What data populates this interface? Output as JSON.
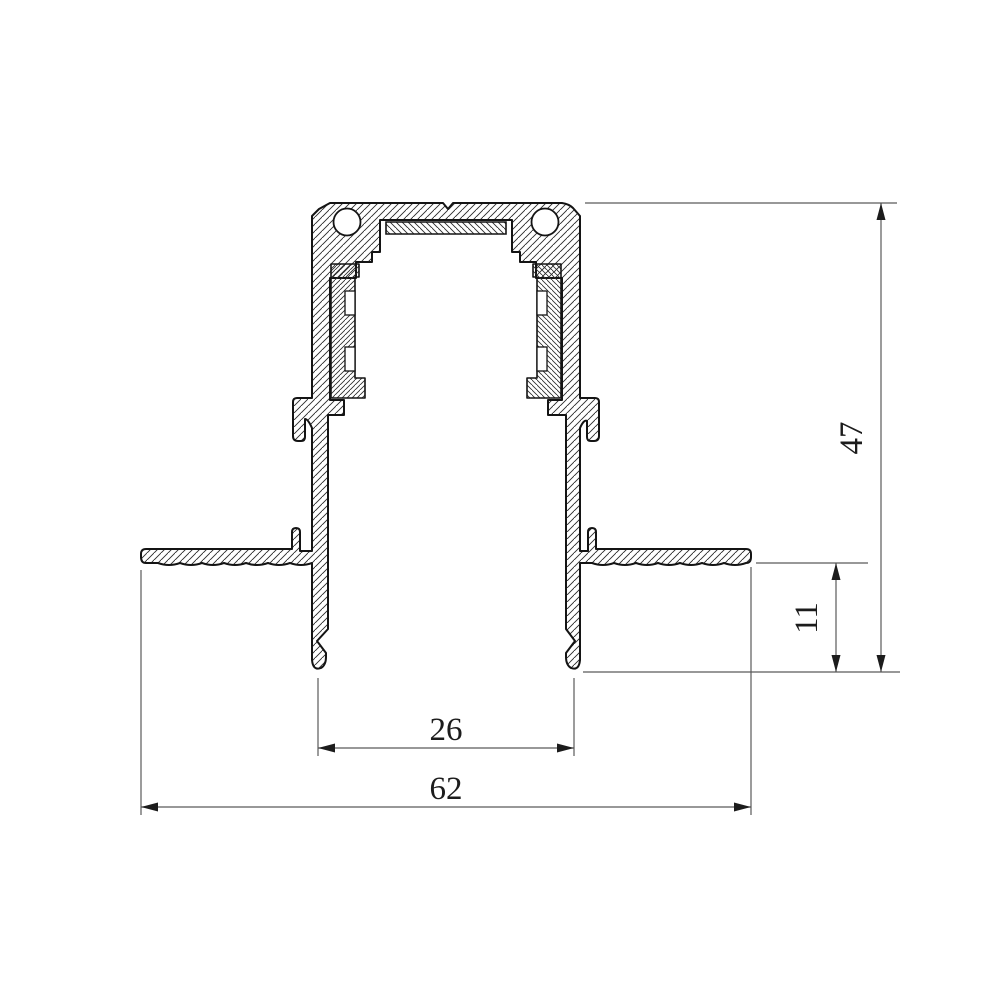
{
  "drawing": {
    "kind": "technical cross-section of recessed aluminum track profile",
    "dimensions": {
      "overall_height": {
        "value": "47",
        "orientation": "vertical"
      },
      "flange_depth": {
        "value": "11",
        "orientation": "vertical"
      },
      "inner_width": {
        "value": "26",
        "orientation": "horizontal"
      },
      "overall_width": {
        "value": "62",
        "orientation": "horizontal"
      }
    },
    "colors": {
      "outline": "#141414",
      "hatch": "#2a2a2a",
      "dimension_lines": "#5a5a5a",
      "arrowheads": "#1c1c1c",
      "background": "#ffffff"
    }
  }
}
